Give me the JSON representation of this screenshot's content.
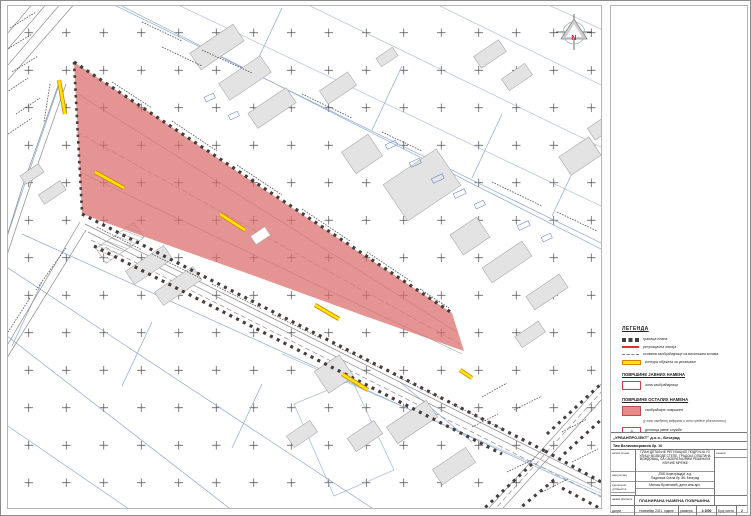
{
  "north": {
    "label": "N"
  },
  "colors": {
    "plan_area_fill": "#db6b6b",
    "boundary_dots": "#453d3a",
    "demolition_yellow": "#f7e800",
    "parcel_blue": "#8fa8d0",
    "regulation_red": "#e03030"
  },
  "legend": {
    "title": "ЛЕГЕНДА",
    "items": [
      {
        "key": "plan-boundary",
        "label": "граница плана"
      },
      {
        "key": "regulation-line",
        "label": "регулациона линија"
      },
      {
        "key": "road-axis",
        "label": "осовина саобраћајнице са висинским котама"
      },
      {
        "key": "demolition",
        "label": "контура објеката за уклањање"
      }
    ],
    "sections": [
      {
        "title": "ПОВРШИНЕ ЈАВНИХ НАМЕНА",
        "items": [
          {
            "key": "road-zone",
            "label": "зона саобраћајнице"
          }
        ]
      },
      {
        "title": "ПОВРШИНЕ ОСТАЛИХ НАМЕНА",
        "items": [
          {
            "key": "traffic-area",
            "label": "саобраћајне површине",
            "note": "(у зони омеђеној задругом и зони средње удаљености)"
          },
          {
            "key": "service-section",
            "symbol": "Д",
            "label": "деоница јавне службе",
            "note": "А–Б: деоница предвиђеног уличног коридора"
          }
        ]
      }
    ]
  },
  "title_block": {
    "company": "„УРБАНПРОЈЕКТ” д.о.о., Београд",
    "subtitle": "Тим Великоморавска бр. 10",
    "label_plan": "назив плана",
    "plan_name": "ПЛАН ДЕТАЉНЕ РЕГУЛАЦИЈЕ ПОДРУЧЈА УЗ УЛИЦУ ВОЈВОДЕ СТЕПЕ, ГРАДСКА ОПШТИНА ВОЖДОВАЦ, СА САОБРАЋАЈНИМ РЕШЕЊЕМ УЛИЧНЕ МРЕЖЕ",
    "label_mark": "ознака",
    "label_client": "наручилац",
    "client_line1": "„ПКБ Корпорација” а.д.",
    "client_line2": "Падинска Скела бр. 86, Београд",
    "label_urbanist": "одговорни урбаниста",
    "urbanist": "Милош Вученовић, дипл.инж.арх.",
    "label_drawing": "назив прилога",
    "drawing_name": "ПЛАНИРАНА НАМЕНА ПОВРШИНА",
    "label_date": "датум",
    "date": "Новембар 2021. године",
    "label_scale": "размера",
    "scale": "1:1000",
    "label_sheet": "Број листа",
    "sheet": "2"
  }
}
